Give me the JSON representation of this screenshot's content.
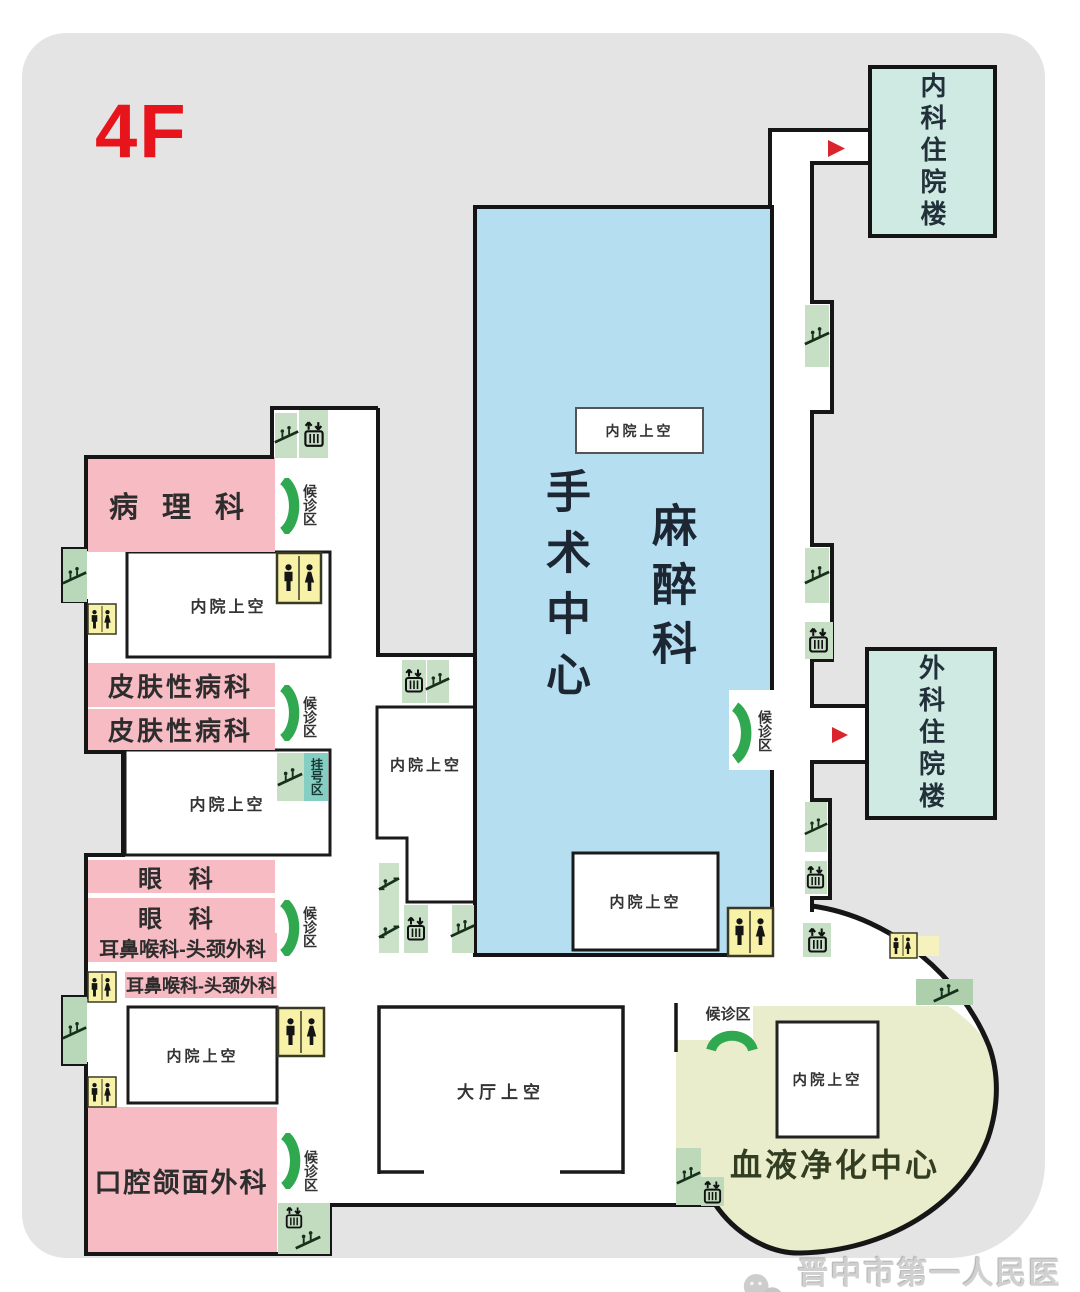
{
  "floor_label": "4F",
  "rooms": {
    "pathology": "病 理 科",
    "dermatology": "皮肤性病科",
    "ophthalmology": "眼  科",
    "ent": "耳鼻喉科-头颈外科",
    "oral_surgery": "口腔颌面外科",
    "surgery_center": "手术中心",
    "anesthesiology": "麻醉科",
    "blood_purification": "血液净化中心"
  },
  "buildings": {
    "internal_medicine_inpatient": "内科住院楼",
    "surgical_inpatient": "外科住院楼"
  },
  "areas": {
    "courtyard_void": "内院上空",
    "hall_void": "大厅上空",
    "waiting_area": "候诊区",
    "registration_area": "挂号区"
  },
  "watermark": {
    "hospital_name": "晋中市第一人民医院"
  },
  "icons": {
    "stairs": "stairs-icon",
    "elevator": "elevator-icon",
    "escalator": "escalator-icon",
    "toilet": "toilet-icon",
    "waiting_arc": "waiting-arc-icon",
    "direction_arrow": "direction-arrow-icon",
    "logo": "wechat-logo-icon"
  },
  "colors": {
    "floor_bg": "#e4e4e4",
    "surgery_blue": "#b6def1",
    "department_pink": "#f6bbc3",
    "inpatient_teal": "#cfe9e3",
    "blood_green": "#e9edcc",
    "icon_green": "#c7dfc5",
    "toilet_yellow": "#f8f2a9",
    "registration_teal": "#84cec4",
    "waiting_arc_green": "#2fa850",
    "arrow_red": "#d9252b",
    "floor_label_red": "#e8141c",
    "wall_black": "#161616"
  }
}
